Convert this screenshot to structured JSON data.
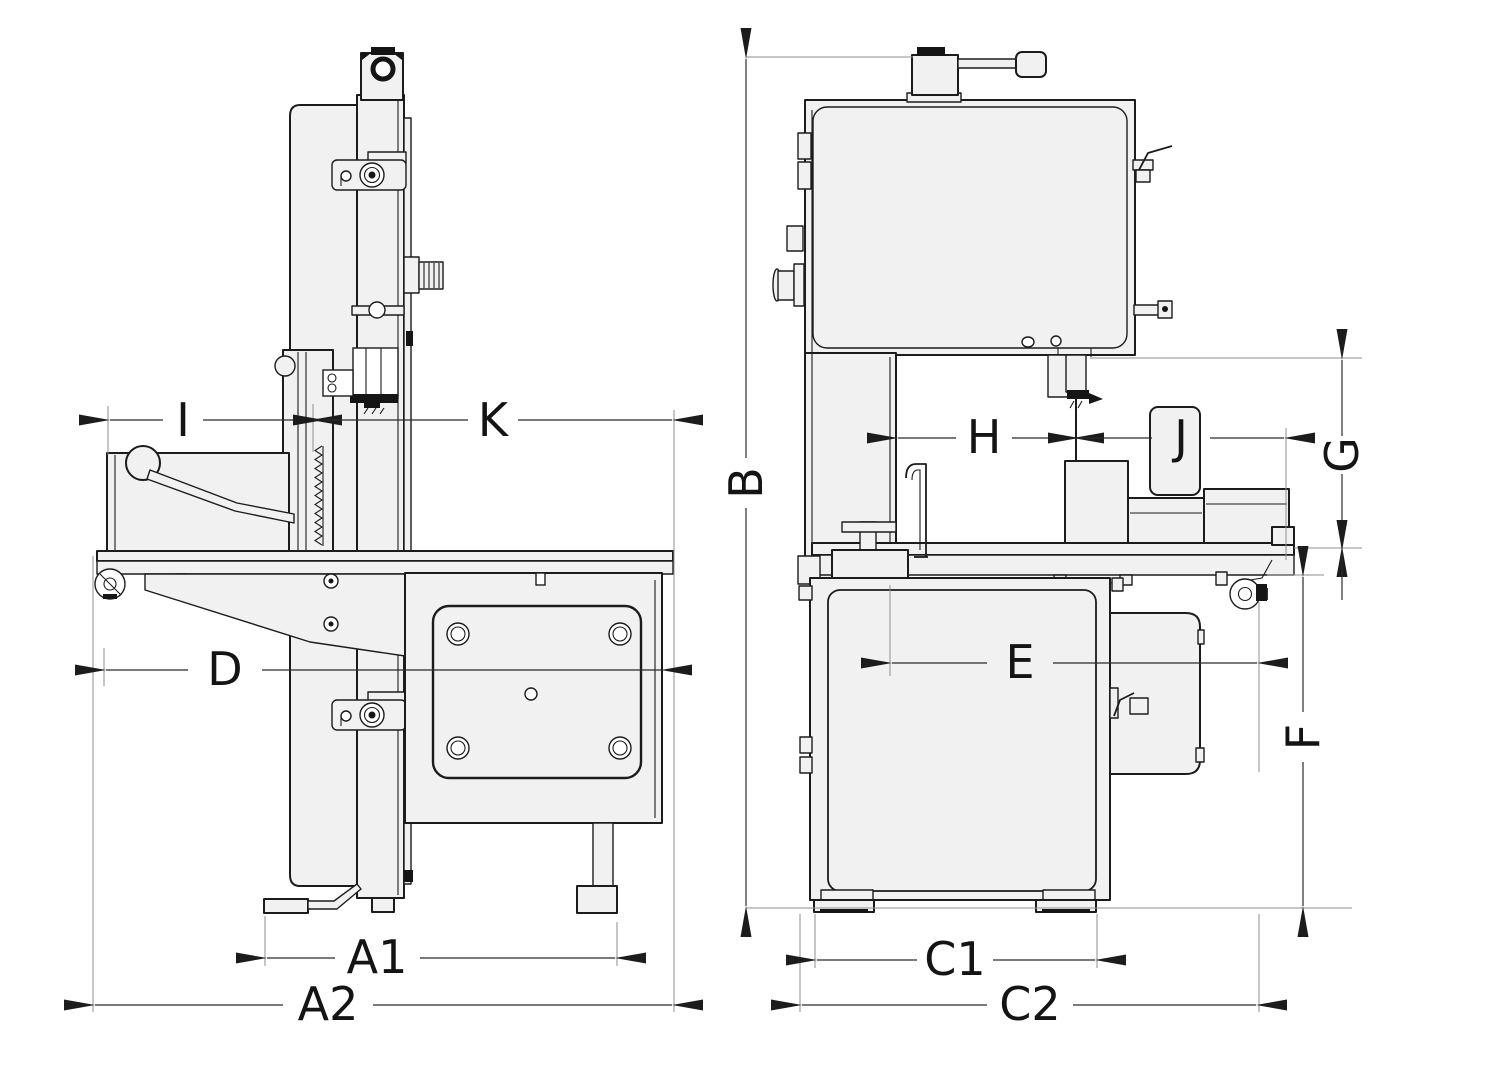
{
  "drawing": {
    "kind": "technical dimensional line drawing",
    "subject": "vertical band saw machine shown in two orthographic views",
    "views": [
      {
        "id": "side",
        "name": "side view (left)"
      },
      {
        "id": "front",
        "name": "front view (right)"
      }
    ]
  },
  "labels": {
    "I": "I",
    "K": "K",
    "D": "D",
    "A1": "A1",
    "A2": "A2",
    "B": "B",
    "H": "H",
    "J": "J",
    "G": "G",
    "E": "E",
    "F": "F",
    "C1": "C1",
    "C2": "C2"
  },
  "colors": {
    "line": "#1c1c1c",
    "body_fill": "#f1f1f1",
    "extension_line": "#8f8f8f",
    "background": "#ffffff"
  }
}
